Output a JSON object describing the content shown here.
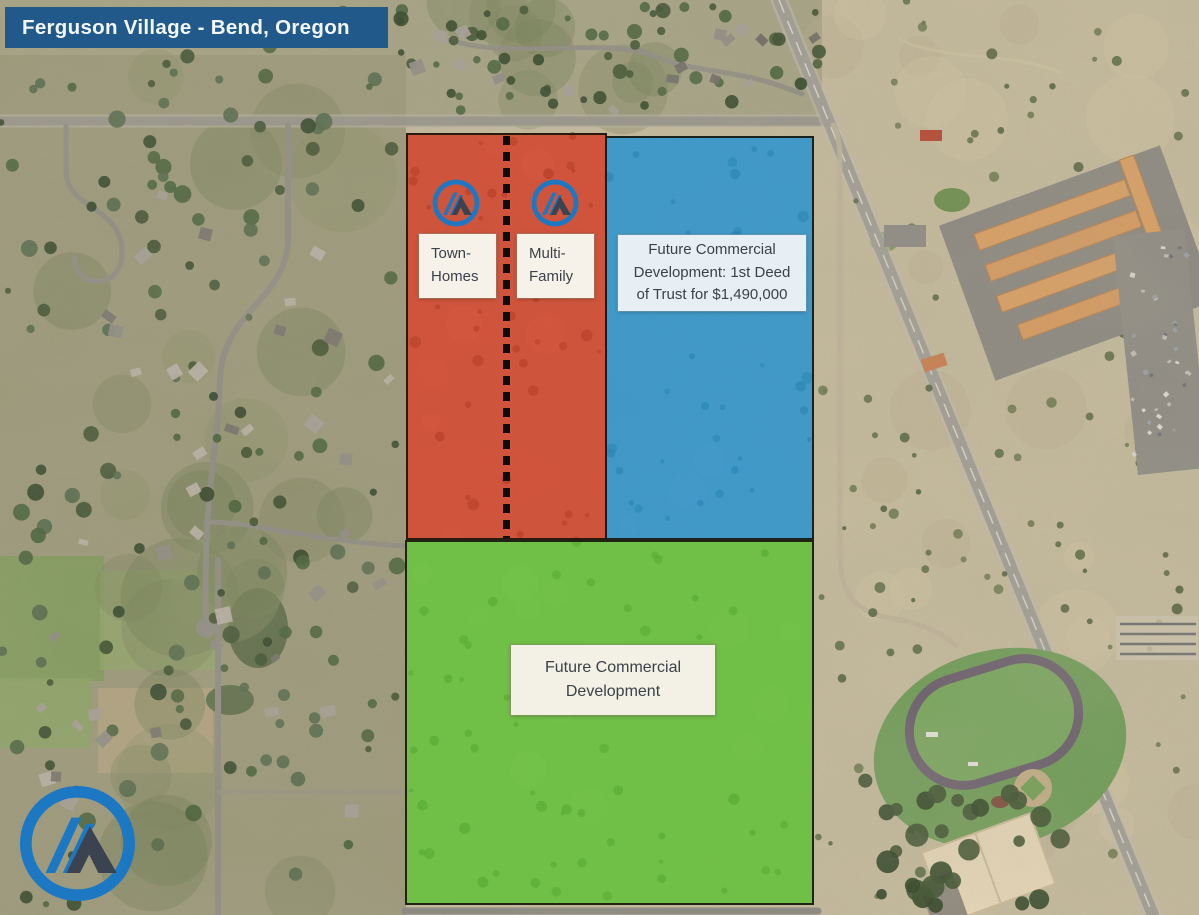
{
  "banner": {
    "title": "Ferguson Village - Bend, Oregon"
  },
  "zones": {
    "townhomes": {
      "label": "Town-\nHomes"
    },
    "multifamily": {
      "label": "Multi-\nFamily"
    },
    "commercial_northeast": {
      "label": "Future Commercial\nDevelopment: 1st Deed\nof Trust for $1,490,000"
    },
    "commercial_south": {
      "label": "Future Commercial\nDevelopment"
    }
  },
  "icons": {
    "brand_logo": "mountain-peak-circle-logo"
  },
  "colors": {
    "banner_bg": "#20598A",
    "zone_red": "#D33821",
    "zone_blue": "#2191D2",
    "zone_green": "#5AC130",
    "divider": "#0D0D08",
    "label_bg": "#F7F2E9",
    "label_bg_blue": "#E7EFF4",
    "label_text": "#3A4149",
    "logo_blue": "#1D78C4",
    "logo_dark": "#3C4350"
  }
}
